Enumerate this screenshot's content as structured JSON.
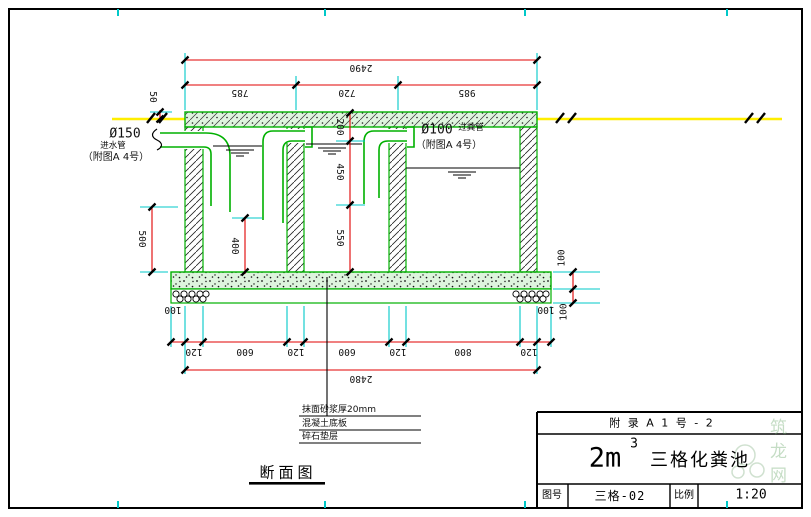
{
  "drawing": {
    "view_title": "断面图",
    "watermark": "筑龙网"
  },
  "colors": {
    "structure_green": "#00b000",
    "dimension_red": "#e00000",
    "extension_cyan": "#00c8c8",
    "ground_yellow": "#ffee00",
    "line_black": "#111111"
  },
  "dims": {
    "top_total": "2490",
    "top_segs": [
      "785",
      "720",
      "985"
    ],
    "ground_offset": "50",
    "left_depth": "500",
    "comp1_depth": "400",
    "mid_chain": [
      "200",
      "450",
      "550"
    ],
    "bottom_segs": [
      "120",
      "600",
      "120",
      "600",
      "120",
      "800",
      "120"
    ],
    "bottom_total": "2480",
    "overhang_left": "100",
    "overhang_right": "100",
    "base_layers": [
      "100",
      "100"
    ]
  },
  "labels": {
    "inlet_dia": "Ø150",
    "inlet_name": "进水管",
    "inlet_ref": "（附图A  4号）",
    "pipe_dia": "Ø100",
    "pipe_name": "过粪管",
    "pipe_ref": "（附图A  4号）",
    "notes": [
      "抹面砂浆厚20mm",
      "混凝土底板",
      "碎石垫层"
    ]
  },
  "titleblock": {
    "appendix": "附 录 A    1 号 - 2",
    "volume": "2m",
    "volume_sup": "3",
    "product": "三格化粪池",
    "drawing_no_label": "图号",
    "drawing_no": "三格-02",
    "scale_label": "比例",
    "scale": "1:20"
  }
}
